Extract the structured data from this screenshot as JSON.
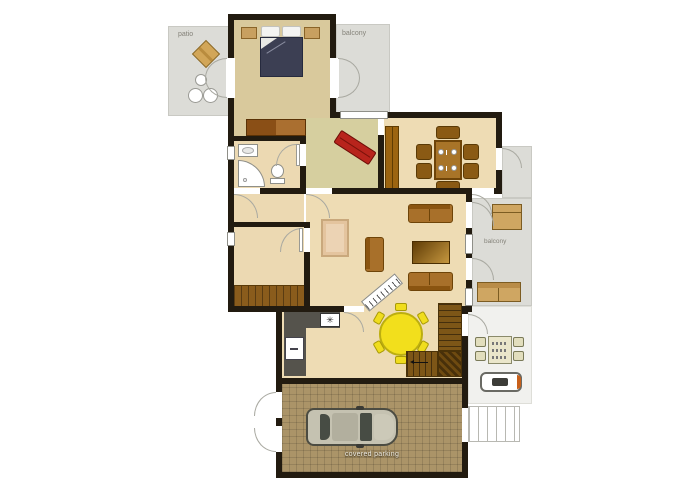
{
  "labels": {
    "patio": "patio",
    "balcony_top": "balcony",
    "balcony_right": "balcony",
    "covered_parking": "covered parking"
  },
  "colors": {
    "wall": "#221b10",
    "bedroom_floor": "#d9c99c",
    "hall_floor": "#d6cf9f",
    "main_floor": "#eedcb4",
    "bathroom_floor": "#ecd9b2",
    "outdoor_gray": "#dcdcd7",
    "terrace_floor": "#f1f1ee",
    "garage_floor": "#ab9468",
    "closet_wood": "#8a5c1c",
    "stair_wood": "#7d5617",
    "furniture_brown": "#a8702a",
    "accent_red_bench": "#b8241c",
    "accent_yellow_table": "#f2df1c",
    "bed_navy": "#3c3f53",
    "car_body": "#c5c2b1",
    "counter_gray": "#55534c",
    "grill_orange": "#c8601a"
  },
  "icons": [
    "double-bed",
    "pillow",
    "nightstand",
    "dresser",
    "patio-table",
    "patio-chair",
    "bathroom-sink",
    "corner-shower",
    "toilet",
    "red-bench",
    "wardrobe",
    "dining-table",
    "dining-chair",
    "plate",
    "sofa",
    "coffee-table",
    "armchair",
    "rug",
    "keyboard-piano",
    "kitchen-counter",
    "stove-burners",
    "refrigerator",
    "breakfast-round-table",
    "stair-flight",
    "balcony-chest",
    "balcony-bench",
    "terrace-table",
    "terrace-chair",
    "barbecue-grill",
    "car-top-view",
    "door-swing-arc",
    "window"
  ]
}
